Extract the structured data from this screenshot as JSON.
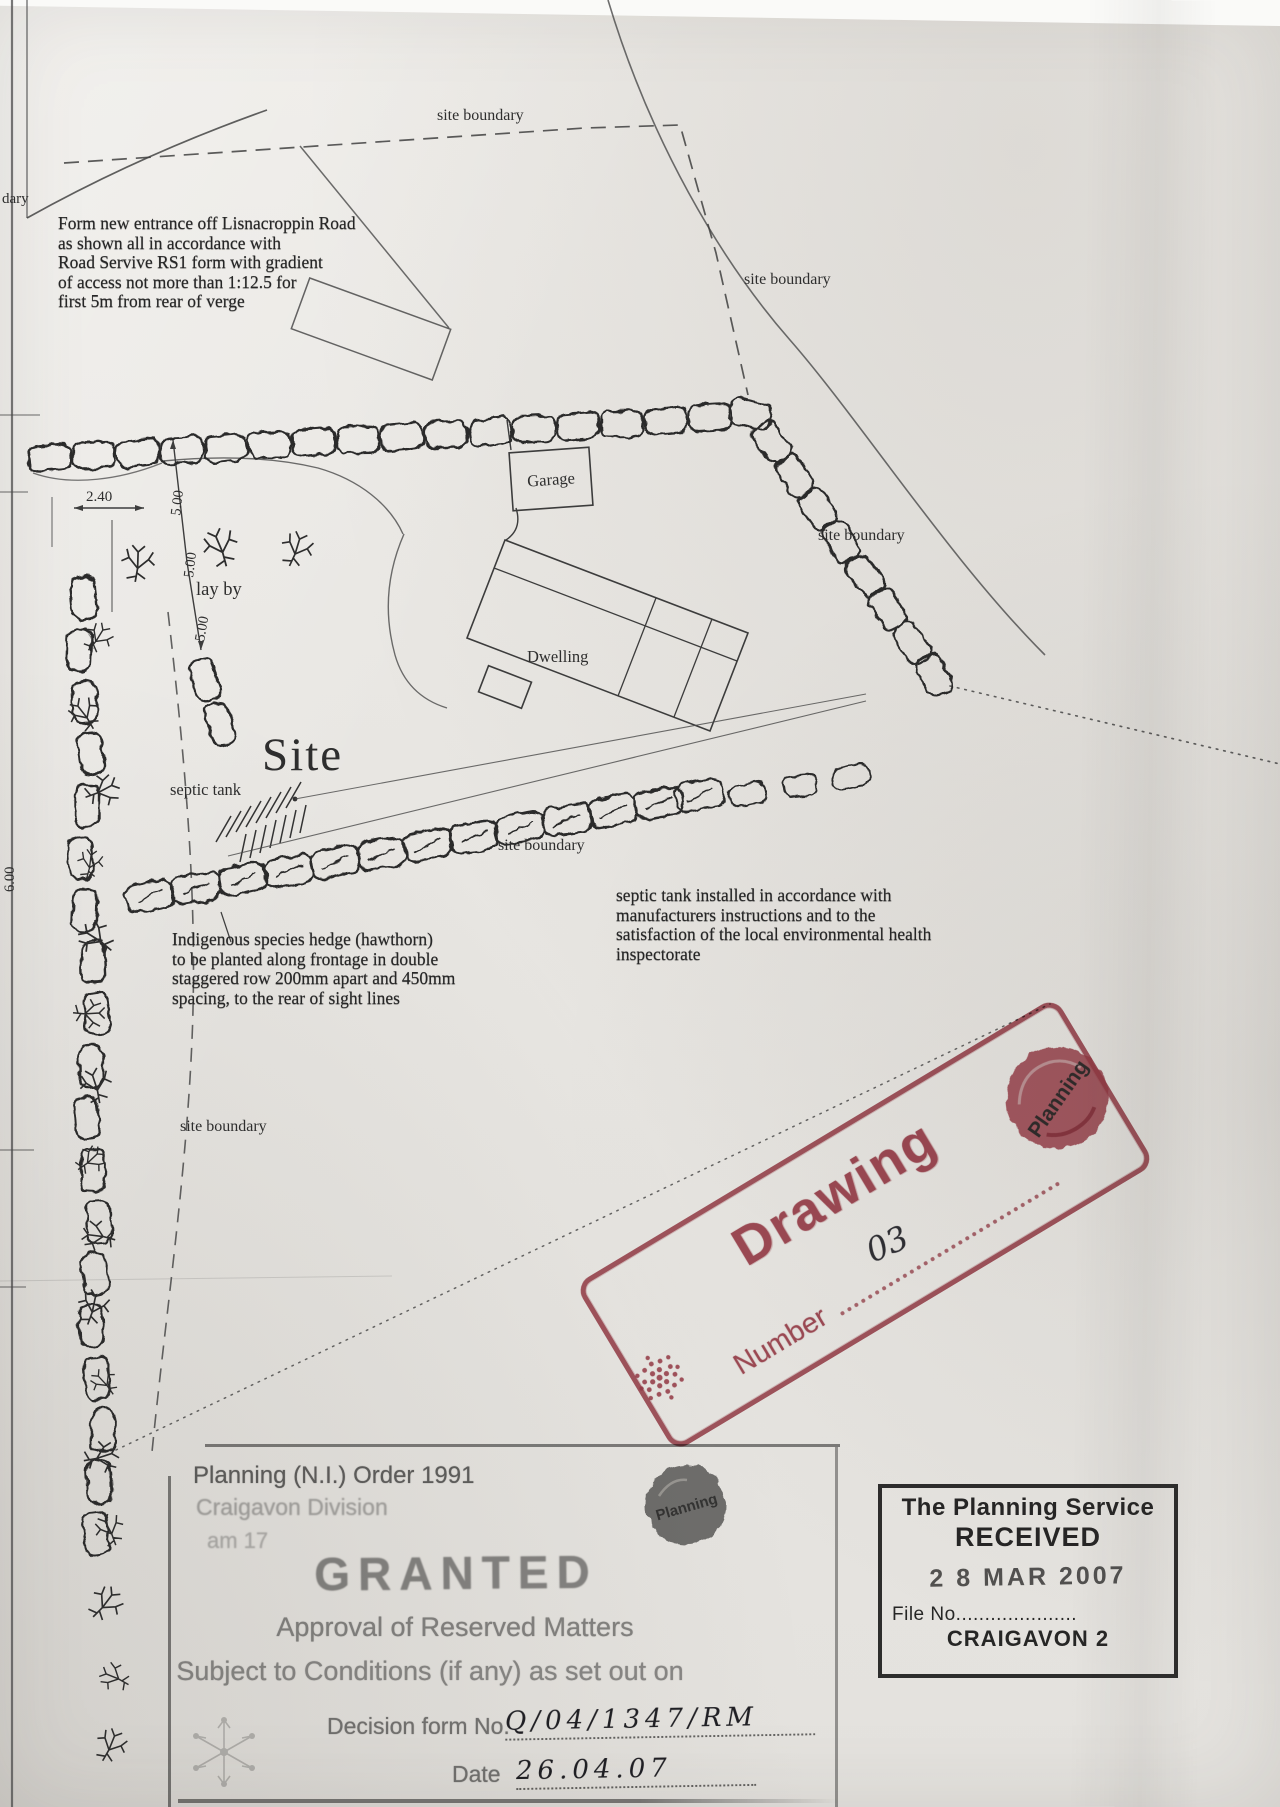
{
  "labels": {
    "site_boundary": "site boundary",
    "boundary_partial": "dary",
    "lay_by": "lay by",
    "site": "Site",
    "septic_tank": "septic tank",
    "garage": "Garage",
    "dwelling": "Dwelling"
  },
  "dimensions": {
    "layby_width": "2.40",
    "offset_5m": "5.00",
    "left_dim": "6.00"
  },
  "notes": {
    "entrance": [
      "Form new entrance off Lisnacroppin Road",
      "as shown all in accordance with",
      "Road Servive RS1 form with gradient",
      "of access not more than 1:12.5 for",
      "first 5m from rear of verge"
    ],
    "hedge": [
      "Indigenous species hedge (hawthorn)",
      "to be planted along frontage in double",
      "staggered row 200mm apart and 450mm",
      "spacing, to the rear of sight lines"
    ],
    "septic": [
      "septic tank installed in accordance with",
      "manufacturers instructions and to the",
      "satisfaction of the local environmental health",
      "inspectorate"
    ]
  },
  "drawing_stamp": {
    "word": "Drawing",
    "number_label": "Number",
    "number_value": "03",
    "logo_text": "Planning",
    "color": "#a43f4d"
  },
  "granted_stamp": {
    "order_line": "Planning (N.I.) Order 1991",
    "division_line": "Craigavon Division",
    "team_line": "am 17",
    "granted": "GRANTED",
    "approval_line": "Approval of Reserved Matters",
    "conditions_line": "Subject to Conditions (if any) as set out on",
    "decision_label": "Decision form No.",
    "decision_value": "Q/04/1347/RM",
    "date_label": "Date",
    "date_value": "26.04.07",
    "logo_text": "Planning"
  },
  "received_stamp": {
    "org": "The Planning Service",
    "received": "RECEIVED",
    "date": "2 8 MAR 2007",
    "file_label": "File No.....................",
    "file_value": "CRAIGAVON 2"
  }
}
